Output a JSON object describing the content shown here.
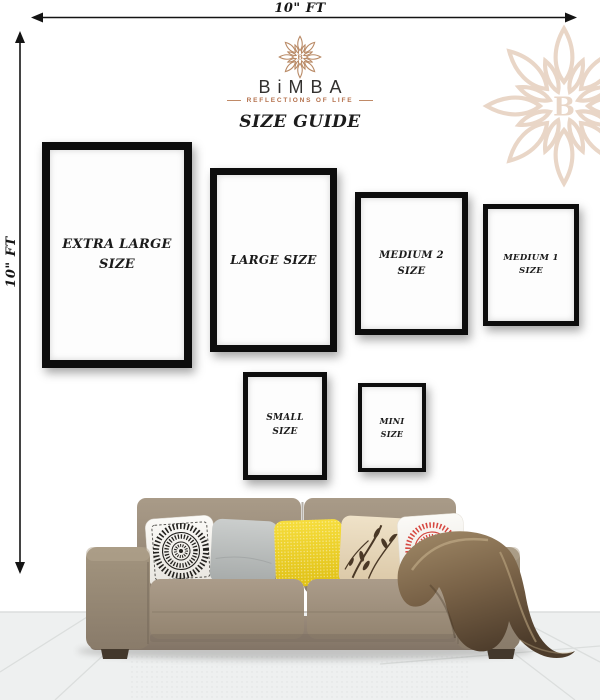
{
  "dimensions": {
    "top_label": "10\" FT",
    "left_label": "10\" FT"
  },
  "brand": {
    "name": "BiMBA",
    "monogram": "B",
    "tagline": "REFLECTIONS OF LIFE",
    "heading": "SIZE GUIDE",
    "logo_color": "#b98a66",
    "watermark_color": "#e9d6c7",
    "name_color": "#33312f",
    "tagline_color": "#b5724e"
  },
  "frames": {
    "extra_large": {
      "label_line1": "EXTRA LARGE",
      "label_line2": "SIZE"
    },
    "large": {
      "label_line1": "LARGE SIZE",
      "label_line2": ""
    },
    "medium2": {
      "label_line1": "MEDIUM 2",
      "label_line2": "SIZE"
    },
    "medium1": {
      "label_line1": "MEDIUM 1",
      "label_line2": "SIZE"
    },
    "small": {
      "label_line1": "SMALL",
      "label_line2": "SIZE"
    },
    "mini": {
      "label_line1": "MINI",
      "label_line2": "SIZE"
    }
  },
  "scene": {
    "sofa_color": "#9b8c7d",
    "blanket_color": "#7a6348",
    "floor_color": "#eef0f0",
    "frame_color": "#0d0d0d",
    "pillows": [
      {
        "name": "black-mandala-pillow",
        "base": "#f5f3f0",
        "accent": "#23211e"
      },
      {
        "name": "plain-gray-pillow",
        "base": "#bcc0bf"
      },
      {
        "name": "yellow-textured-pillow",
        "base": "#f0d32b"
      },
      {
        "name": "cream-floral-pillow",
        "base": "#e9dabd",
        "accent": "#4a3826"
      },
      {
        "name": "red-mandala-pillow",
        "base": "#f7f2ea",
        "accent": "#d6463f"
      }
    ]
  }
}
